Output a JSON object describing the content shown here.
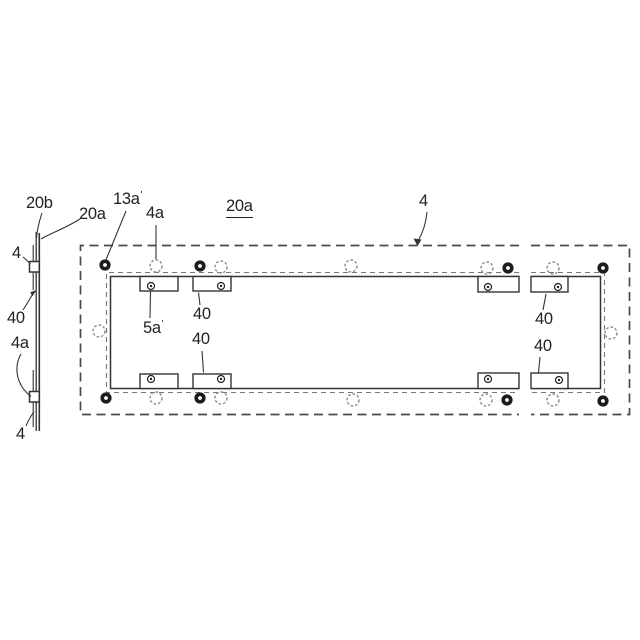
{
  "figure": {
    "background_color": "#ffffff",
    "line_color": "#333333",
    "dashed_frame_color": "#4a4a4a",
    "hidden_line_color": "#777777",
    "open_hole_color": "#8a8a8a",
    "bolt_color": "#1c1c1c",
    "views": {
      "side_view": "thin panel edge with two mounting strips and two clips",
      "plan_view": "long dashed mounting frame with inner flanged opening, shown broken between left and right portions"
    }
  },
  "prime_mark": "'",
  "annotations": [
    {
      "id": "20b-side",
      "text": "20b",
      "prime": false
    },
    {
      "id": "20a-side",
      "text": "20a",
      "prime": false
    },
    {
      "id": "4-side-top",
      "text": "4",
      "prime": false
    },
    {
      "id": "40-side",
      "text": "40",
      "prime": false
    },
    {
      "id": "4a-side",
      "text": "4a",
      "prime": false
    },
    {
      "id": "4-side-bottom",
      "text": "4",
      "prime": false
    },
    {
      "id": "13a-top",
      "text": "13a",
      "prime": true
    },
    {
      "id": "4a-top",
      "text": "4a",
      "prime": false
    },
    {
      "id": "20a-title",
      "text": "20a",
      "prime": false,
      "underlined": true
    },
    {
      "id": "4-arrow",
      "text": "4",
      "prime": false
    },
    {
      "id": "5a-inner",
      "text": "5a",
      "prime": true
    },
    {
      "id": "40-left-upper",
      "text": "40",
      "prime": false
    },
    {
      "id": "40-left-lower",
      "text": "40",
      "prime": false
    },
    {
      "id": "40-right-upper",
      "text": "40",
      "prime": false
    },
    {
      "id": "40-right-lower",
      "text": "40",
      "prime": false
    }
  ],
  "holes": {
    "bolt_holes_top": [
      [
        105,
        265
      ],
      [
        200,
        266
      ],
      [
        508,
        268
      ],
      [
        603,
        268
      ]
    ],
    "bolt_holes_bottom": [
      [
        106,
        398
      ],
      [
        200,
        398
      ],
      [
        507,
        400
      ],
      [
        603,
        401
      ]
    ],
    "open_holes_top": [
      [
        156,
        266
      ],
      [
        221,
        267
      ],
      [
        351,
        266
      ],
      [
        487,
        268
      ],
      [
        553,
        268
      ]
    ],
    "open_holes_bottom": [
      [
        156,
        398
      ],
      [
        221,
        398
      ],
      [
        353,
        400
      ],
      [
        486,
        400
      ],
      [
        553,
        400
      ]
    ],
    "open_holes_sides": [
      [
        99,
        331
      ],
      [
        611,
        333
      ]
    ],
    "bracket_holes_top": [
      [
        151,
        286
      ],
      [
        221,
        286
      ],
      [
        488,
        287
      ],
      [
        558,
        287
      ]
    ],
    "bracket_holes_bottom": [
      [
        151,
        379
      ],
      [
        221,
        379
      ],
      [
        488,
        379
      ],
      [
        559,
        380
      ]
    ]
  }
}
